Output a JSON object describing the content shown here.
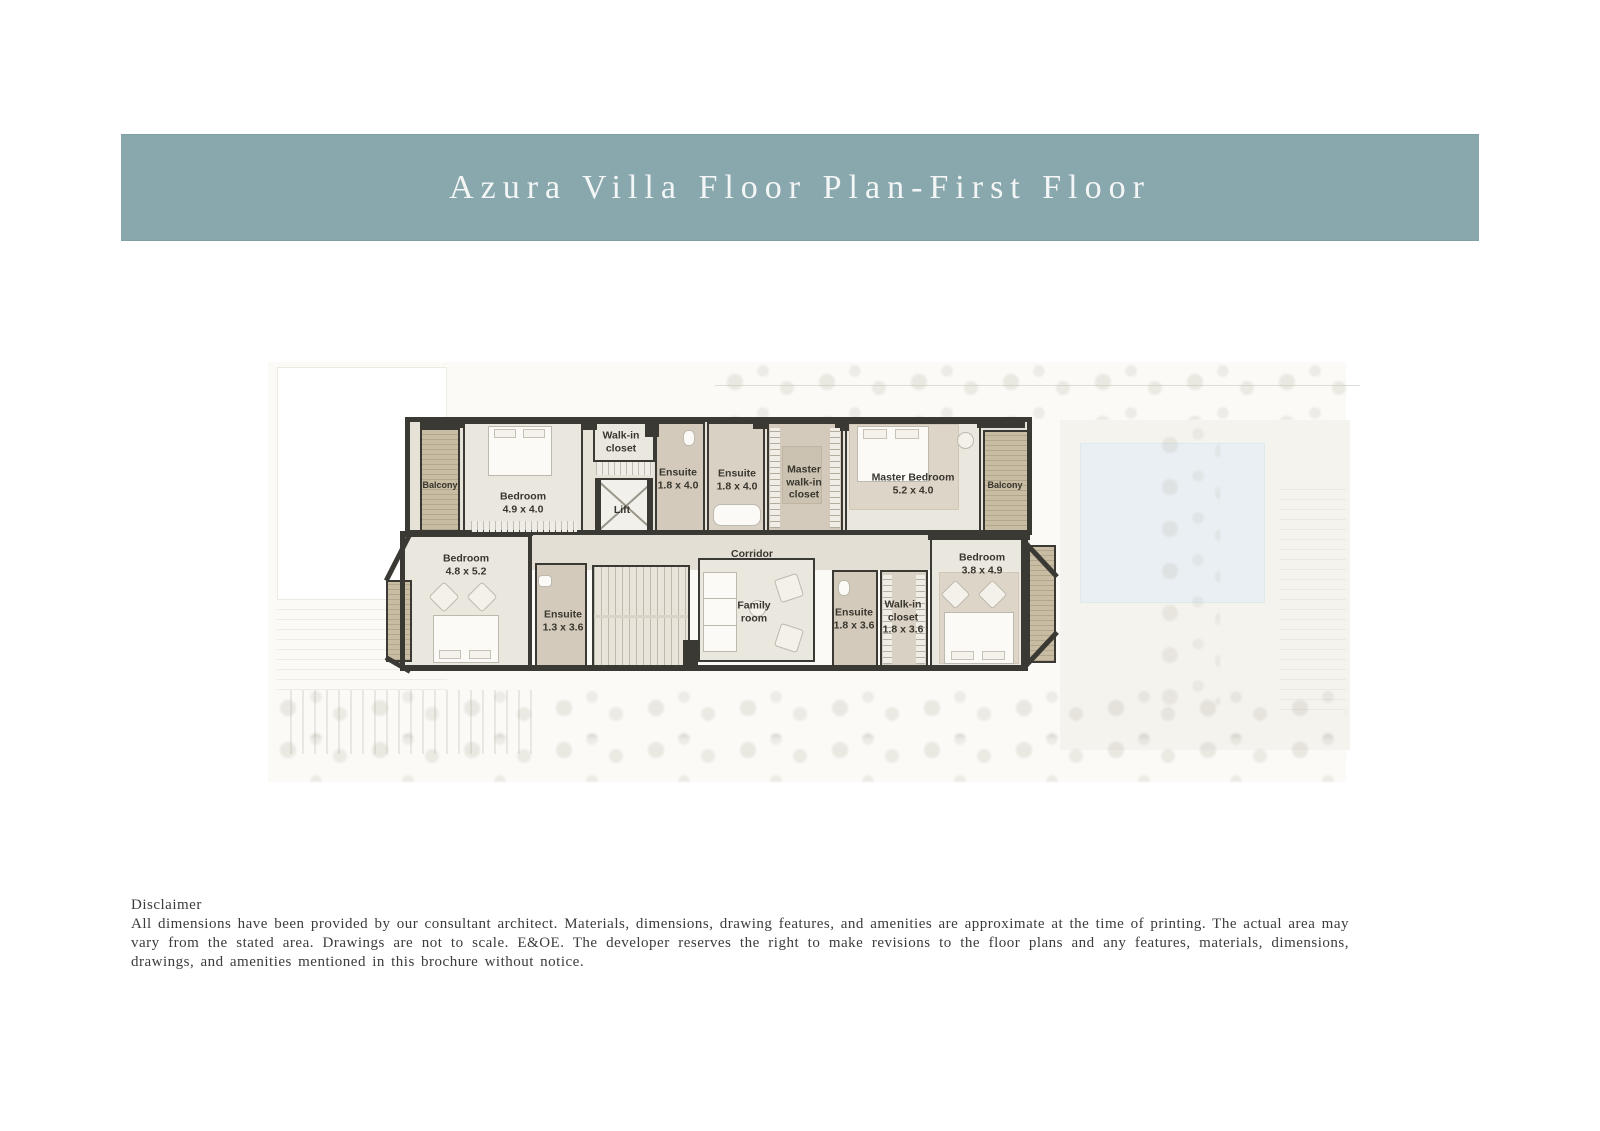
{
  "header": {
    "title": "Azura Villa Floor Plan-First Floor",
    "bg_color": "#88a8ae",
    "text_color": "#f3f6f5"
  },
  "plan": {
    "wall_color": "#3b3934",
    "floor_color": "#eae7df",
    "ensuite_floor_color": "#d3cabb",
    "deck_color": "#c8bca3",
    "pool_color": "#e9eff3",
    "label_color": "#38362e",
    "rooms": {
      "balcony_left": {
        "name": "Balcony"
      },
      "bedroom_1": {
        "name": "Bedroom",
        "dim": "4.9 x 4.0"
      },
      "walk_in_closet_1": {
        "name": "Walk-in closet"
      },
      "lift": {
        "name": "Lift"
      },
      "ensuite_a": {
        "name": "Ensuite",
        "dim": "1.8 x 4.0"
      },
      "ensuite_b": {
        "name": "Ensuite",
        "dim": "1.8 x 4.0"
      },
      "master_wic": {
        "name": "Master walk-in closet"
      },
      "master_bedroom": {
        "name": "Master Bedroom",
        "dim": "5.2 x 4.0"
      },
      "balcony_right": {
        "name": "Balcony"
      },
      "corridor": {
        "name": "Corridor"
      },
      "bedroom_2": {
        "name": "Bedroom",
        "dim": "4.8 x 5.2"
      },
      "ensuite_c": {
        "name": "Ensuite",
        "dim": "1.3 x 3.6"
      },
      "family_room": {
        "name": "Family room"
      },
      "ensuite_d": {
        "name": "Ensuite",
        "dim": "1.8 x 3.6"
      },
      "walk_in_closet_2": {
        "name": "Walk-in closet",
        "dim": "1.8 x 3.6"
      },
      "bedroom_3": {
        "name": "Bedroom",
        "dim": "3.8 x 4.9"
      }
    }
  },
  "disclaimer": {
    "heading": "Disclaimer",
    "body": "All dimensions have been provided by our consultant architect. Materials, dimensions, drawing features, and amenities are approximate at the time of printing. The actual area may vary from the stated area. Drawings are not to scale. E&OE. The developer reserves the right to make revisions to the floor plans and any features, materials, dimensions, drawings, and amenities mentioned in this brochure without notice."
  }
}
